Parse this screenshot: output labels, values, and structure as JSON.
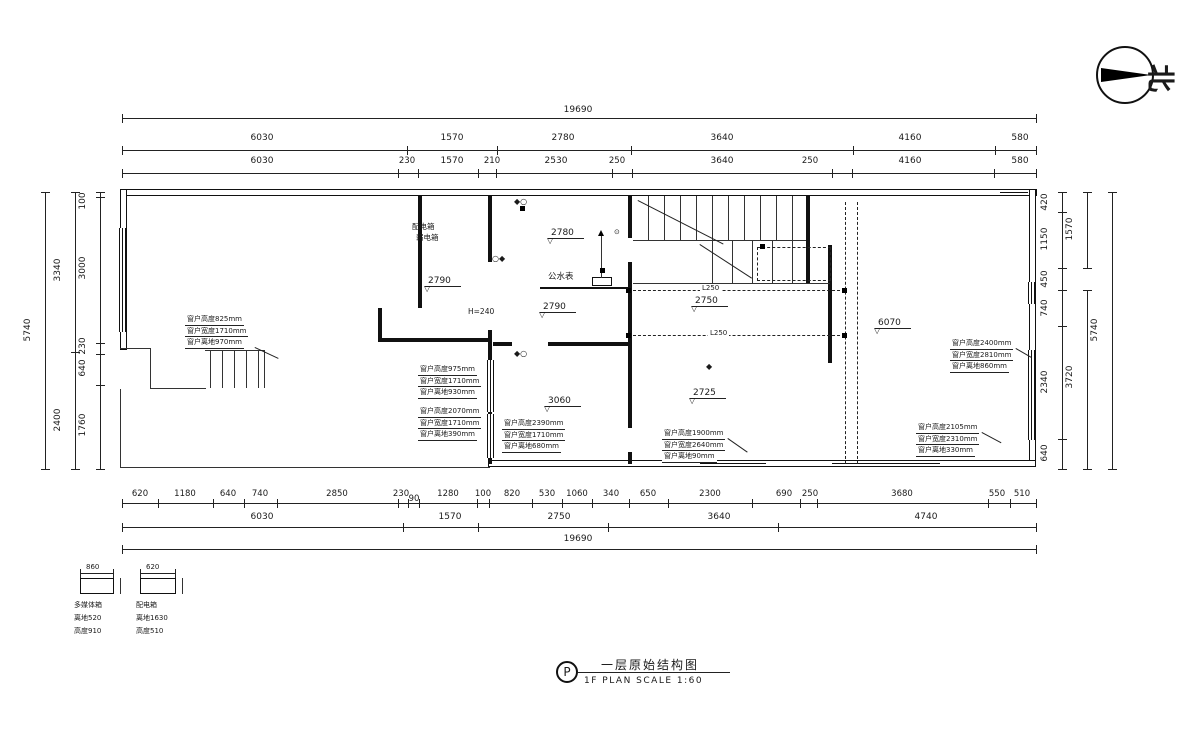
{
  "north": "北",
  "title": {
    "mark": "P",
    "cn": "一层原始结构图",
    "en": "1F PLAN   SCALE   1:60"
  },
  "dims": {
    "top_total": "19690",
    "top2": [
      "6030",
      "1570",
      "2780",
      "3640",
      "4160",
      "580"
    ],
    "top3": [
      "6030",
      "230",
      "1570",
      "210",
      "2530",
      "250",
      "3640",
      "250",
      "4160",
      "580"
    ],
    "bot1": [
      "620",
      "1180",
      "640",
      "740",
      "2850",
      "230",
      "90",
      "1280",
      "100",
      "820",
      "530",
      "1060",
      "340",
      "650",
      "2300",
      "690",
      "250",
      "3680",
      "550",
      "510"
    ],
    "bot2": [
      "6030",
      "1570",
      "2750",
      "3640",
      "4740"
    ],
    "bot_total": "19690",
    "left_outer": "5740",
    "left_mid": [
      "3340",
      "2400"
    ],
    "left_in": [
      "100",
      "3000",
      "230",
      "640",
      "1760"
    ],
    "right_in": [
      "420",
      "1150",
      "450",
      "740",
      "2340",
      "640"
    ],
    "right_mid": [
      "1570",
      "3720"
    ],
    "right_outer": "5740"
  },
  "levels": [
    "2780",
    "2790",
    "2790",
    "2750",
    "2725",
    "3060",
    "6070"
  ],
  "beams": [
    "L250",
    "L250"
  ],
  "labels": {
    "power_box": "配电箱",
    "weak_box": "弱电箱",
    "water_meter": "公水表",
    "opening_height": "H=240"
  },
  "annos": {
    "a": [
      "窗户高度825mm",
      "窗户宽度1710mm",
      "窗户离地970mm"
    ],
    "b": [
      "窗户高度975mm",
      "窗户宽度1710mm",
      "窗户离地930mm"
    ],
    "c": [
      "窗户高度2070mm",
      "窗户宽度1710mm",
      "窗户离地390mm"
    ],
    "d": [
      "窗户高度2390mm",
      "窗户宽度1710mm",
      "窗户离地680mm"
    ],
    "e": [
      "窗户高度2400mm",
      "窗户宽度2810mm",
      "窗户离地860mm"
    ],
    "f": [
      "窗户高度2105mm",
      "窗户宽度2310mm",
      "窗户离地330mm"
    ],
    "g": [
      "窗户高度1900mm",
      "窗户宽度2640mm",
      "窗户离地90mm"
    ]
  },
  "details": {
    "d1": {
      "dim": "860",
      "name": "多媒体箱",
      "l2": "离地520",
      "l3": "高度910"
    },
    "d2": {
      "dim": "620",
      "name": "配电箱",
      "l2": "离地1630",
      "l3": "高度510"
    }
  }
}
